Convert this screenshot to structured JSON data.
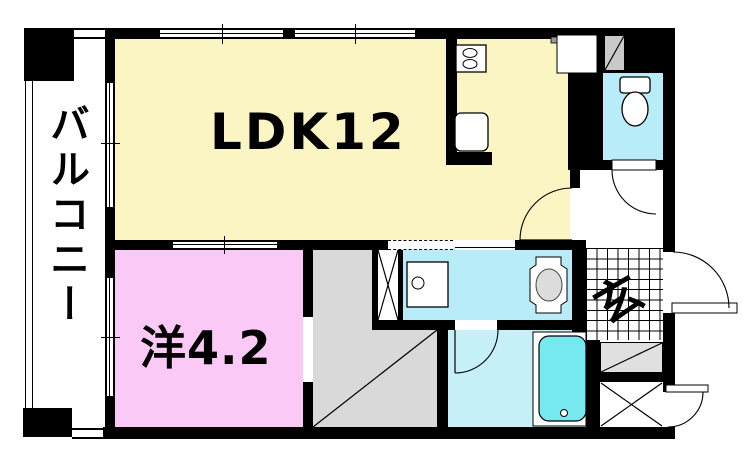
{
  "title": "apartment-floor-plan",
  "colors": {
    "wall": "#000000",
    "ldk": "#FAF5C2",
    "western": "#FBC9F6",
    "water": "#B7ECF8",
    "bath": "#C6F0F8",
    "tub": "#76E9F0",
    "hallgray": "#D9D9D9",
    "psgray": "#C9C9C9",
    "shoegray": "#E0E0E0",
    "fixgray": "#DCDCDC"
  },
  "rooms": {
    "ldk": {
      "label": "LDK12"
    },
    "western": {
      "label": "洋4.2"
    },
    "balcony": {
      "label": "バルコニー"
    },
    "entrance": {
      "label": "玄"
    }
  },
  "fixtures": [
    "stove-icon",
    "sink-icon",
    "refrigerator-icon",
    "toilet-icon",
    "washbasin-icon",
    "washing-machine-icon",
    "bathtub-icon",
    "pipe-space",
    "shoe-cabinet",
    "storage-closet",
    "trunk-room"
  ]
}
